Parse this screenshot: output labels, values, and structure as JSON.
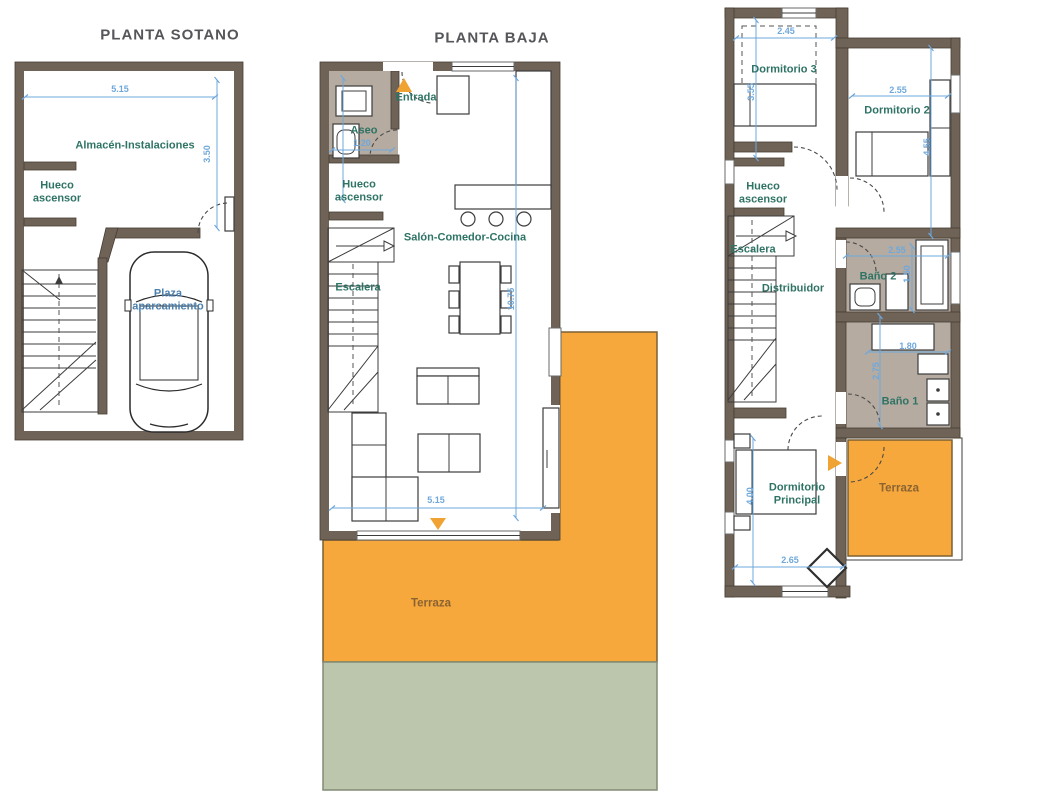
{
  "sheet": {
    "type": "architectural-floor-plans",
    "background": "#ffffff"
  },
  "palette": {
    "wall": "#6f6358",
    "dimension": "#6fa8dc",
    "room_label": "#2f7365",
    "parking_label": "#4a7fae",
    "terrace_label": "#8a6332",
    "terrace_fill": "#f7a83c",
    "garden_fill": "#bcc6ac",
    "bath_fill": "#b5aba1",
    "entry_marker": "#f0a232",
    "title": "#55565a"
  },
  "plans": {
    "sotano": {
      "title": "PLANTA SOTANO",
      "rooms": {
        "almacen": "Almacén-Instalaciones",
        "hueco_ascensor": "Hueco\nascensor",
        "plaza": "Plaza\naparcamiento"
      },
      "dims": {
        "width": "5.15",
        "height": "3.50"
      }
    },
    "baja": {
      "title": "PLANTA BAJA",
      "rooms": {
        "entrada": "Entrada",
        "aseo": "Aseo",
        "hueco_ascensor": "Hueco\nascensor",
        "escalera": "Escalera",
        "salon": "Salón-Comedor-Cocina",
        "terraza": "Terraza"
      },
      "dims": {
        "aseo_width": "1.20",
        "height": "10.75",
        "width": "5.15"
      }
    },
    "alta": {
      "rooms": {
        "dormitorio3": "Dormitorio 3",
        "dormitorio2": "Dormitorio 2",
        "hueco_ascensor": "Hueco\nascensor",
        "escalera": "Escalera",
        "distribuidor": "Distribuidor",
        "bano2": "Baño 2",
        "bano1": "Baño 1",
        "dormitorio_principal": "Dormitorio\nPrincipal",
        "terraza": "Terraza"
      },
      "dims": {
        "dorm3_width": "2.45",
        "dorm3_height": "3.55",
        "dorm2_width": "2.55",
        "dorm2_height": "4.55",
        "bano2_width": "2.55",
        "bano2_height": "1.50",
        "hall_width": "1.80",
        "hall_height": "2.75",
        "dormppal_height": "4.00",
        "dormppal_width": "2.65"
      }
    }
  }
}
